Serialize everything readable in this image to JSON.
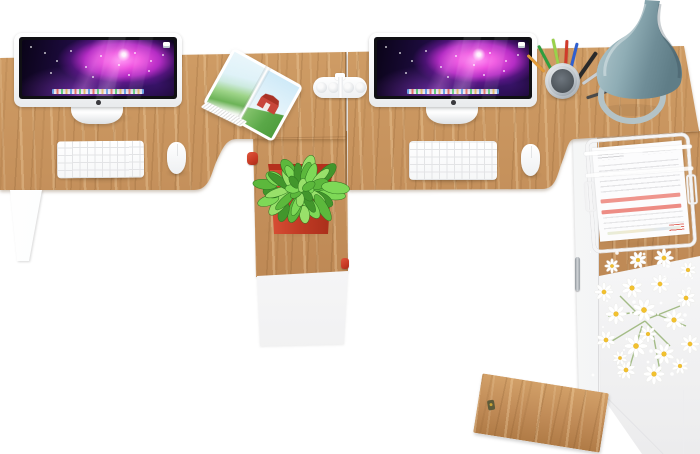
{
  "meta": {
    "title": "Top view of a two-seat office workstation with storage pedestals",
    "scene_type": "product-photo-top-view"
  },
  "colors": {
    "background": "#ffffff",
    "wood_light": "#d2a068",
    "wood_base": "#c08b57",
    "wood_grain_dark": "#7e5226",
    "cabinet_white": "#f7f7f8",
    "screen_bezel": "#101014",
    "nebula_pink": "#ff82ef",
    "nebula_magenta": "#e33fd9",
    "nebula_deep_purple": "#1d0b3e",
    "planter_red": "#c73a24",
    "plant_green": "#5cb83c",
    "lamp_gray_teal": "#8fadb5",
    "flower_white": "#ffffff",
    "flower_yellow": "#f2c12e",
    "highlight_red_bar": "#ef958d",
    "pen_colors": [
      "#2f9e3e",
      "#9ad14b",
      "#d13a2a",
      "#2f5fd0",
      "#2a2a2a",
      "#e09a3a",
      "#c9ced3",
      "#4a4a4a"
    ]
  },
  "objects": {
    "left_workstation": {
      "monitor": "silver all-in-one monitor with purple nebula wallpaper",
      "keyboard": "white wireless keyboard",
      "mouse": "white mouse",
      "magazine": "open magazine with red barn photo"
    },
    "right_workstation": {
      "monitor": "silver all-in-one monitor with purple nebula wallpaper",
      "keyboard": "white wireless keyboard",
      "mouse": "white mouse",
      "pen_cup": "metal mesh cup with colored pens",
      "lamp": "gray-teal cone desk lamp with ring base"
    },
    "between_desks": {
      "speaker": "white pill bluetooth speaker"
    },
    "left_pedestal": {
      "plant": "green speckled plant in red square planter",
      "knob": "red drawer knob"
    },
    "right_pedestal": {
      "document_tray": "white wire letter tray stacked with printed documents",
      "flowers": "bouquet of white daisies",
      "door": "wooden drop-down door with key in lock",
      "handle": "vertical metal door handle"
    }
  }
}
